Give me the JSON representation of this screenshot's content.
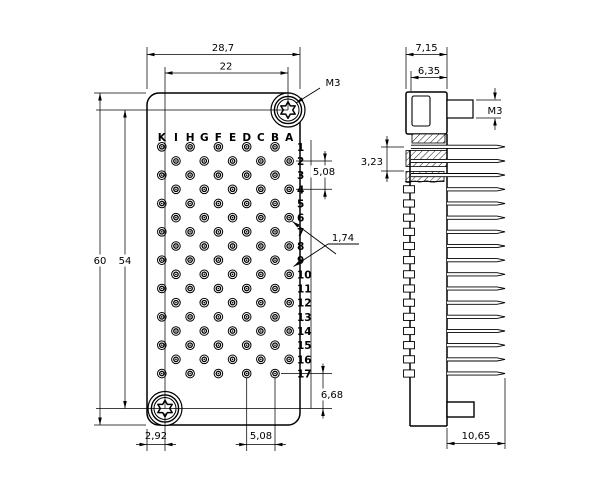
{
  "drawing": {
    "type": "engineering-connector-drawing",
    "colors": {
      "line": "#000000",
      "background": "#ffffff"
    },
    "front_view": {
      "column_labels": [
        "K",
        "I",
        "H",
        "G",
        "F",
        "E",
        "D",
        "C",
        "B",
        "A"
      ],
      "row_labels": [
        "1",
        "2",
        "3",
        "4",
        "5",
        "6",
        "7",
        "8",
        "9",
        "10",
        "11",
        "12",
        "13",
        "14",
        "15",
        "16",
        "17"
      ],
      "pin_pattern": {
        "odd_row_columns": [
          "K",
          "H",
          "F",
          "D",
          "B"
        ],
        "even_row_columns": [
          "I",
          "G",
          "E",
          "C",
          "A"
        ]
      },
      "dim_labels": {
        "overall_width": "28,7",
        "screw_spacing_h": "22",
        "screw_thread": "M3",
        "overall_height": "60",
        "screw_spacing_v": "54",
        "row_pitch": "5,08",
        "pin_diameter": "1,74",
        "last_row_offset": "6,68",
        "col_pitch": "5,08",
        "edge_offset": "2,92"
      }
    },
    "side_view": {
      "dim_labels": {
        "overall_depth": "7,15",
        "body_depth": "6,35",
        "stud_thread": "M3",
        "row_offset": "3,23",
        "pin_length": "10,65"
      }
    }
  }
}
